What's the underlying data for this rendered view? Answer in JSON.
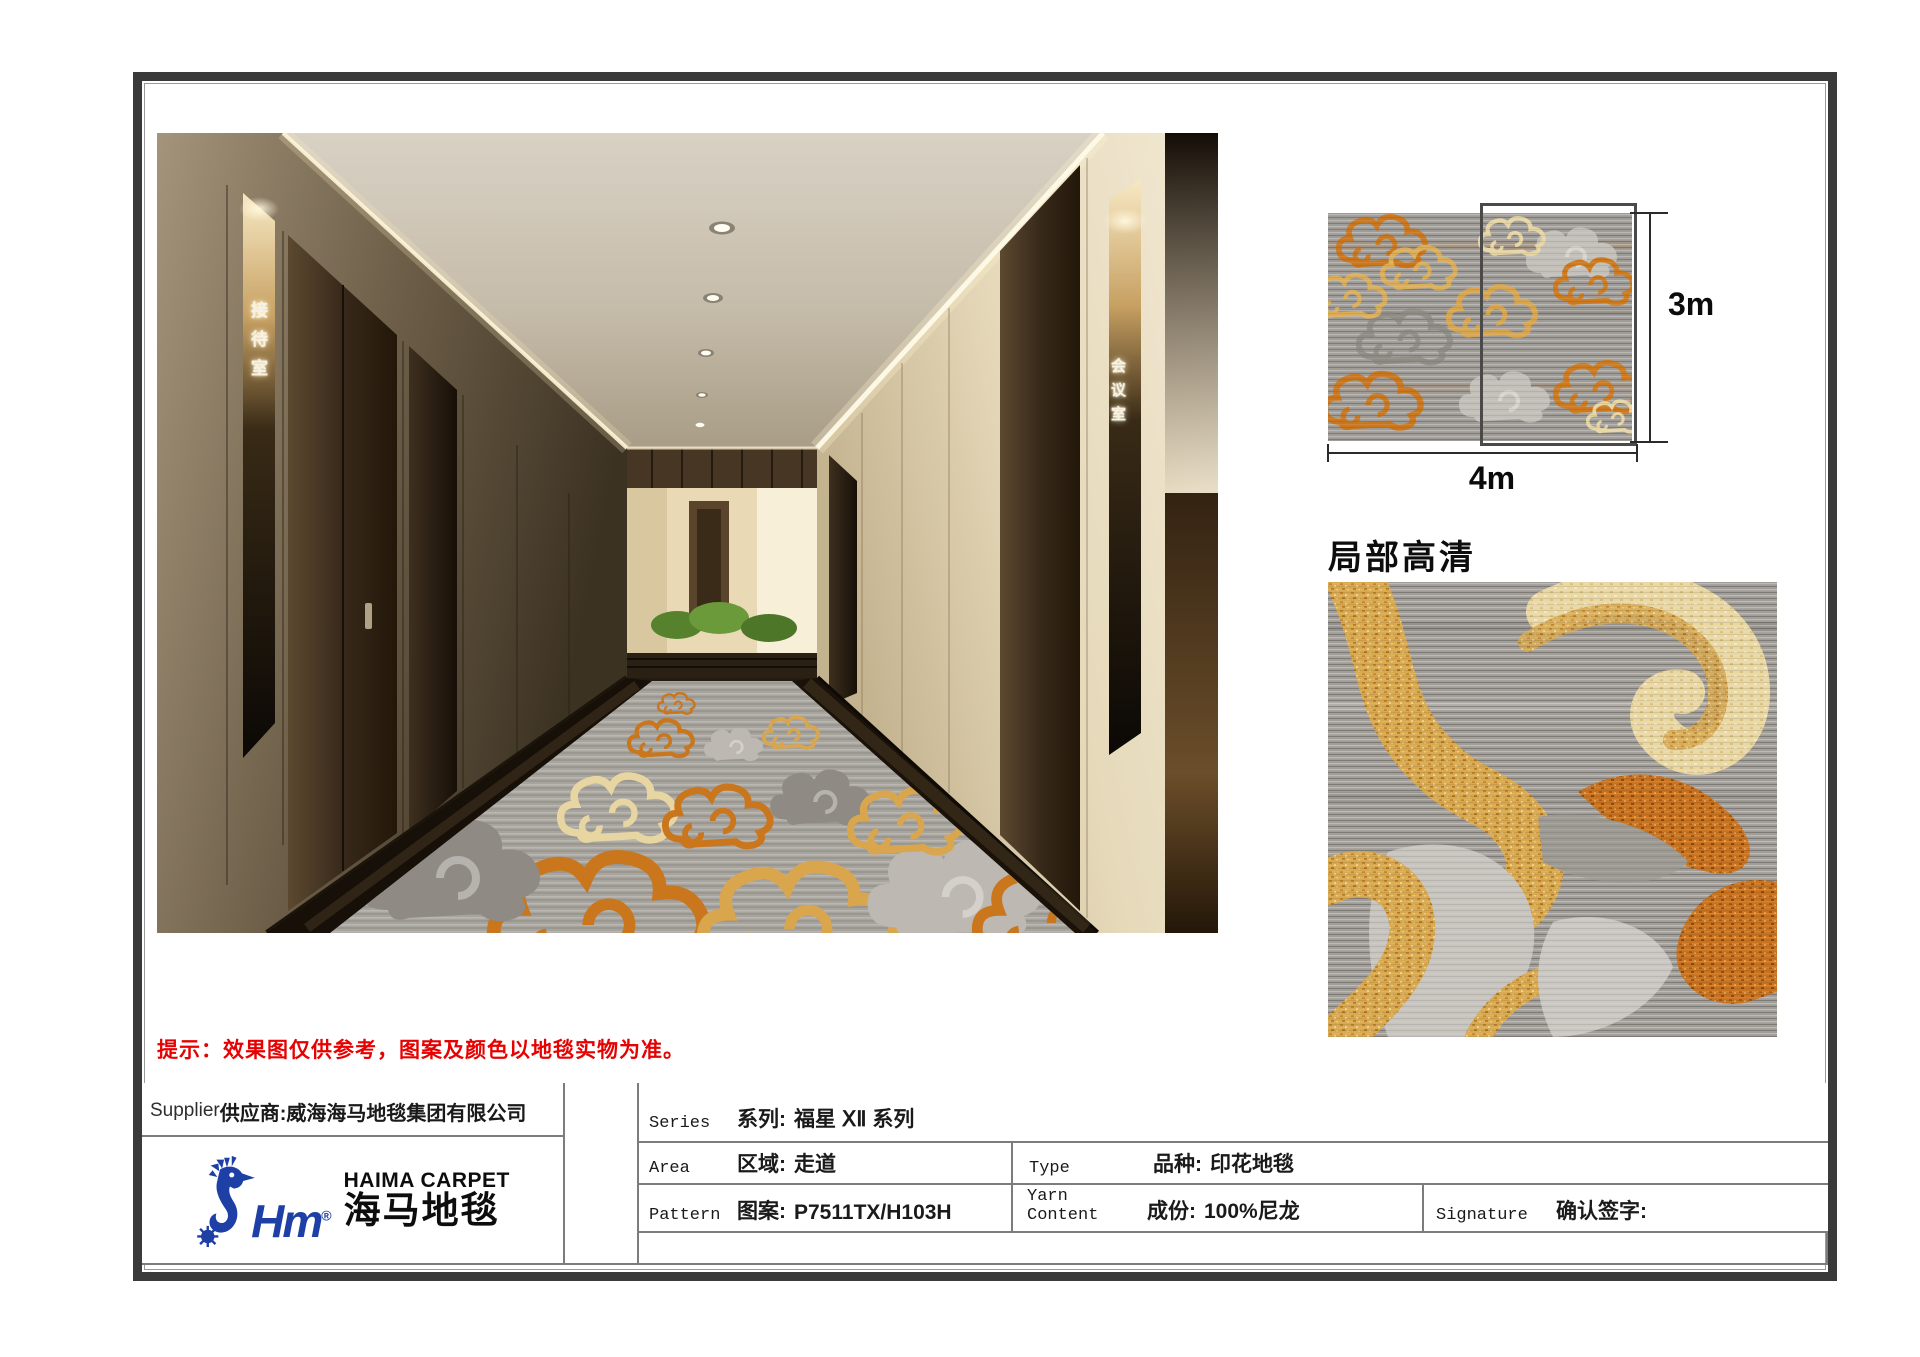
{
  "document": {
    "notice": "提示：效果图仅供参考，图案及颜色以地毯实物为准。",
    "detail_title": "局部高清",
    "dimensions": {
      "height": "3m",
      "width": "4m"
    },
    "corridor": {
      "left_door_sign": "接待室",
      "right_door_sign": "会议室"
    }
  },
  "logo": {
    "monogram": "Hm",
    "registered": "®",
    "brand_en": "HAIMA CARPET",
    "brand_zh": "海马地毯"
  },
  "table": {
    "supplier": {
      "en": "Supplier",
      "zh": "供应商:",
      "value": "威海海马地毯集团有限公司"
    },
    "series": {
      "en": "Series",
      "zh": "系列:",
      "value": "福星 ⅩⅡ 系列"
    },
    "area": {
      "en": "Area",
      "zh": "区域:",
      "value": "走道"
    },
    "type": {
      "en": "Type",
      "zh": "品种:",
      "value": "印花地毯"
    },
    "pattern": {
      "en": "Pattern",
      "zh": "图案:",
      "value": "P7511TX/H103H"
    },
    "yarn_content": {
      "en": "Yarn Content",
      "zh": "成份:",
      "value": "100%尼龙"
    },
    "signature": {
      "en": "Signature",
      "zh": "确认签字:"
    }
  },
  "colors": {
    "notice_red": "#e60202",
    "logo_blue": "#1d3fa6",
    "carpet_orange": "#c9761d",
    "carpet_gold": "#d9a64e",
    "carpet_cream": "#e9d8a4",
    "carpet_gray_base": "#a7a39d"
  }
}
